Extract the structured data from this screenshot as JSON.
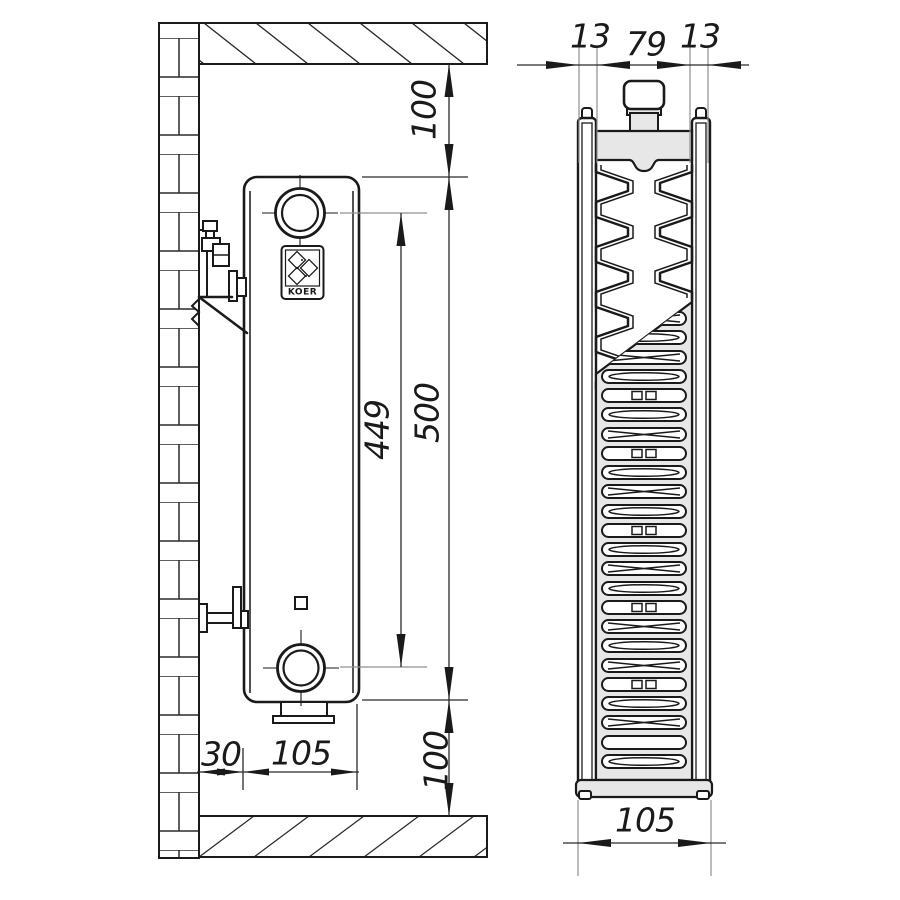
{
  "drawing_title": "Panel radiator wall-mounting dimensional drawing",
  "side_view": {
    "top_clearance": "100",
    "height": "500",
    "port_spacing": "449",
    "bottom_clearance": "100",
    "wall_gap": "30",
    "depth": "105",
    "logo": "KOER"
  },
  "section_view": {
    "panel_back": "13",
    "core": "79",
    "panel_front": "13",
    "depth": "105"
  }
}
